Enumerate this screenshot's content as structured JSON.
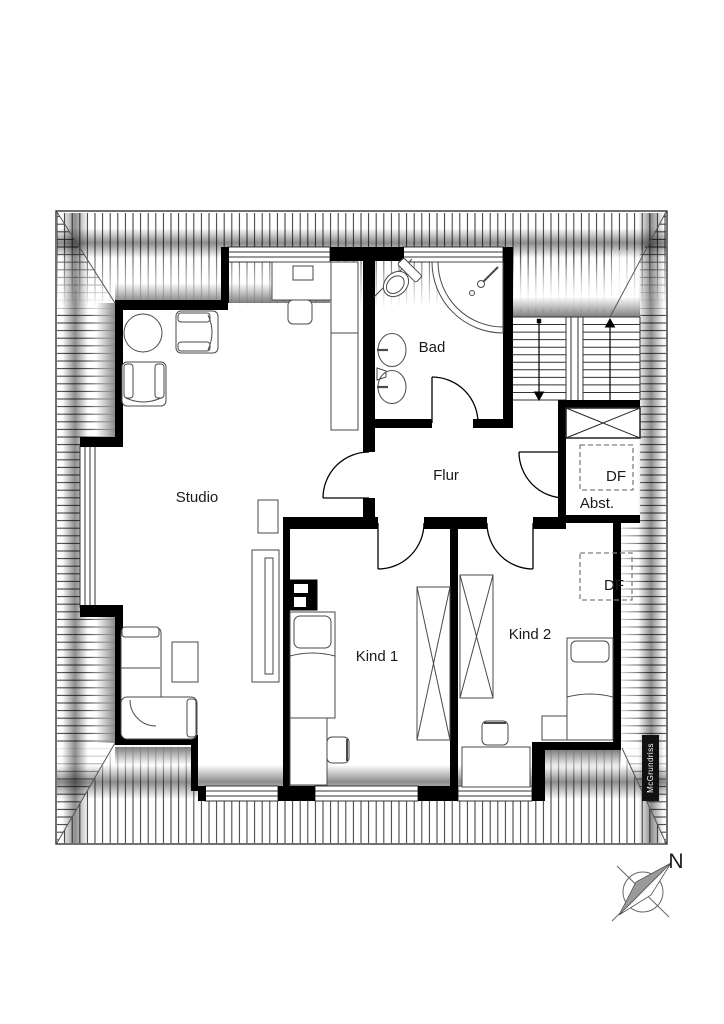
{
  "plan": {
    "room_labels": {
      "studio": "Studio",
      "bad": "Bad",
      "flur": "Flur",
      "kind1": "Kind 1",
      "kind2": "Kind 2",
      "abstell": "Abst."
    },
    "roof_windows": {
      "df1": "DF",
      "df2": "DF"
    },
    "compass": {
      "north": "N"
    },
    "watermark": {
      "text": "McGrundriss"
    },
    "colors": {
      "wall": "#000000",
      "hatch_line": "#3f3f3f",
      "furniture_stroke": "#4a4a4a",
      "dashed_box": "#808080"
    }
  }
}
